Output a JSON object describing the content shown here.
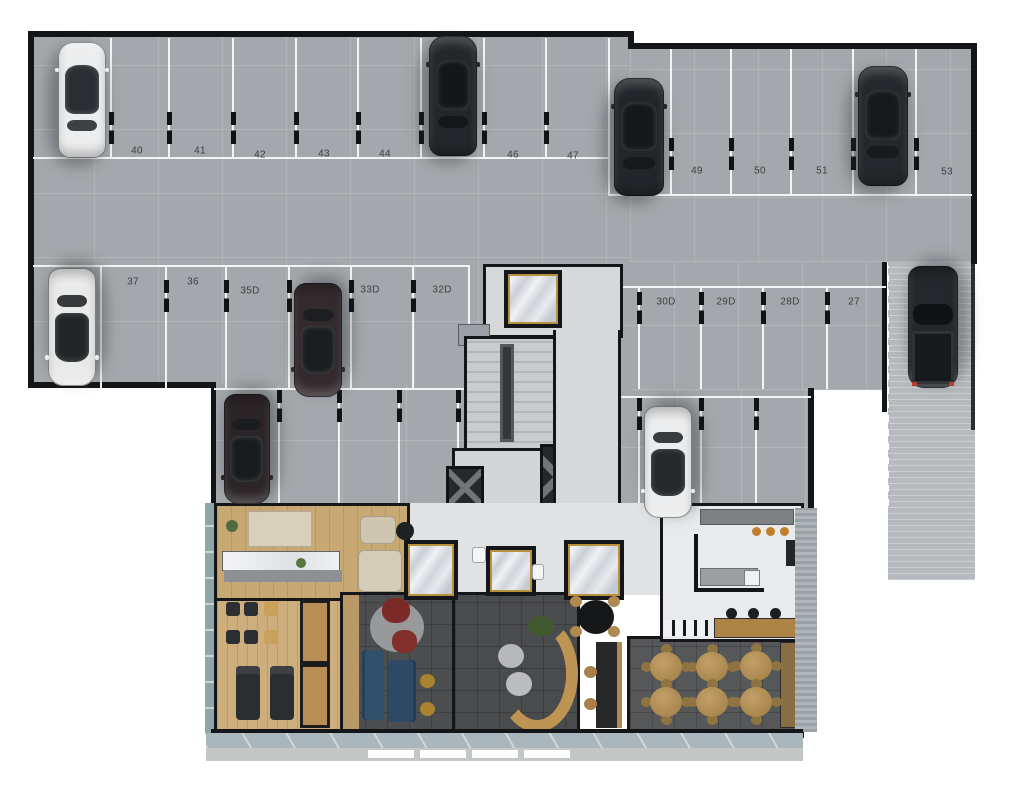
{
  "title": "residential-building-floor-plan-parking-and-lobby",
  "palette": {
    "garage_floor": "#a4a8ac",
    "stall_line": "#f2f3f2",
    "wall": "#131518",
    "ramp": "#b6babe",
    "wood_floor": "#c8a873",
    "deck_floor": "#cfae7e",
    "lounge_floor": "#4c4e50",
    "light_floor": "#e0e2e4",
    "marble_gold": "#b8913f",
    "sofa_blue": "#2e4a63",
    "pouf_red": "#7c2a28",
    "dining_table_wood": "#b29058",
    "canopy": "#a9b6bb",
    "sidewalk": "#c3c7c6"
  },
  "parking": {
    "row_top": [
      {
        "label": "39",
        "cx": 80,
        "y": 148
      },
      {
        "label": "40",
        "cx": 137,
        "y": 151
      },
      {
        "label": "41",
        "cx": 200,
        "y": 151
      },
      {
        "label": "42",
        "cx": 260,
        "y": 155
      },
      {
        "label": "43",
        "cx": 324,
        "y": 154
      },
      {
        "label": "44",
        "cx": 385,
        "y": 154
      },
      {
        "label": "45",
        "cx": 452,
        "y": 152
      },
      {
        "label": "46",
        "cx": 513,
        "y": 155
      },
      {
        "label": "47",
        "cx": 573,
        "y": 156
      },
      {
        "label": "48",
        "cx": 635,
        "y": 182
      },
      {
        "label": "49",
        "cx": 697,
        "y": 171
      },
      {
        "label": "50",
        "cx": 760,
        "y": 171
      },
      {
        "label": "51",
        "cx": 822,
        "y": 171
      },
      {
        "label": "52",
        "cx": 883,
        "y": 171
      },
      {
        "label": "53",
        "cx": 947,
        "y": 172
      }
    ],
    "row_middle": [
      {
        "label": "38",
        "cx": 63,
        "y": 280
      },
      {
        "label": "37",
        "cx": 133,
        "y": 282
      },
      {
        "label": "36",
        "cx": 193,
        "y": 282
      },
      {
        "label": "35D",
        "cx": 250,
        "y": 291
      },
      {
        "label": "34D",
        "cx": 312,
        "y": 291
      },
      {
        "label": "33D",
        "cx": 370,
        "y": 290
      },
      {
        "label": "32D",
        "cx": 442,
        "y": 290
      },
      {
        "label": "31",
        "cx": 610,
        "y": 302
      },
      {
        "label": "30D",
        "cx": 666,
        "y": 302
      },
      {
        "label": "29D",
        "cx": 726,
        "y": 302
      },
      {
        "label": "28D",
        "cx": 790,
        "y": 302
      },
      {
        "label": "27",
        "cx": 854,
        "y": 302
      }
    ]
  },
  "cars": [
    {
      "space": "39",
      "kind": "sedan",
      "body": "#ecedee",
      "glass": "#2a2e33",
      "accent": "#9a9da0",
      "x": 56,
      "y": 42,
      "w": 52,
      "h": 116,
      "facing": "up"
    },
    {
      "space": "45",
      "kind": "sedan",
      "body": "#23272b",
      "glass": "#14171a",
      "accent": "#3a3e42",
      "x": 427,
      "y": 36,
      "w": 52,
      "h": 120,
      "facing": "up"
    },
    {
      "space": "48",
      "kind": "sedan",
      "body": "#22262a",
      "glass": "#15181b",
      "accent": "#3a3e42",
      "x": 612,
      "y": 78,
      "w": 54,
      "h": 118,
      "facing": "up"
    },
    {
      "space": "52",
      "kind": "sedan",
      "body": "#24282c",
      "glass": "#16191c",
      "accent": "#5a2126",
      "x": 856,
      "y": 66,
      "w": 54,
      "h": 120,
      "facing": "up"
    },
    {
      "space": "38",
      "kind": "sedan",
      "body": "#e9eaea",
      "glass": "#232629",
      "accent": "#9a9da0",
      "x": 46,
      "y": 268,
      "w": 52,
      "h": 118,
      "facing": "down"
    },
    {
      "space": "34D",
      "kind": "sedan",
      "body": "#332a2d",
      "glass": "#1a1d20",
      "accent": "#6e2a2a",
      "x": 292,
      "y": 283,
      "w": 52,
      "h": 114,
      "facing": "down"
    },
    {
      "space": "35D-lower",
      "kind": "sedan",
      "body": "#2c2528",
      "glass": "#191c1f",
      "accent": "#7a2f2f",
      "x": 222,
      "y": 394,
      "w": 50,
      "h": 110,
      "facing": "down"
    },
    {
      "space": "30D-lower",
      "kind": "sedan",
      "body": "#ecedee",
      "glass": "#25282c",
      "accent": "#9a9da0",
      "x": 642,
      "y": 406,
      "w": 52,
      "h": 112,
      "facing": "down"
    },
    {
      "space": "ramp",
      "kind": "truck",
      "body": "#24272b",
      "glass": "#101315",
      "accent": "#c03a2a",
      "x": 906,
      "y": 266,
      "w": 54,
      "h": 122,
      "facing": "down"
    }
  ],
  "amenities": {
    "lobby_elevator_shafts": 3,
    "dining_tables": 6,
    "dining_chairs_per_table": 4,
    "lounge_poufs": 2,
    "sunbeds": 2,
    "bar_stools_black": 3,
    "bar_stools_orange": 3
  }
}
